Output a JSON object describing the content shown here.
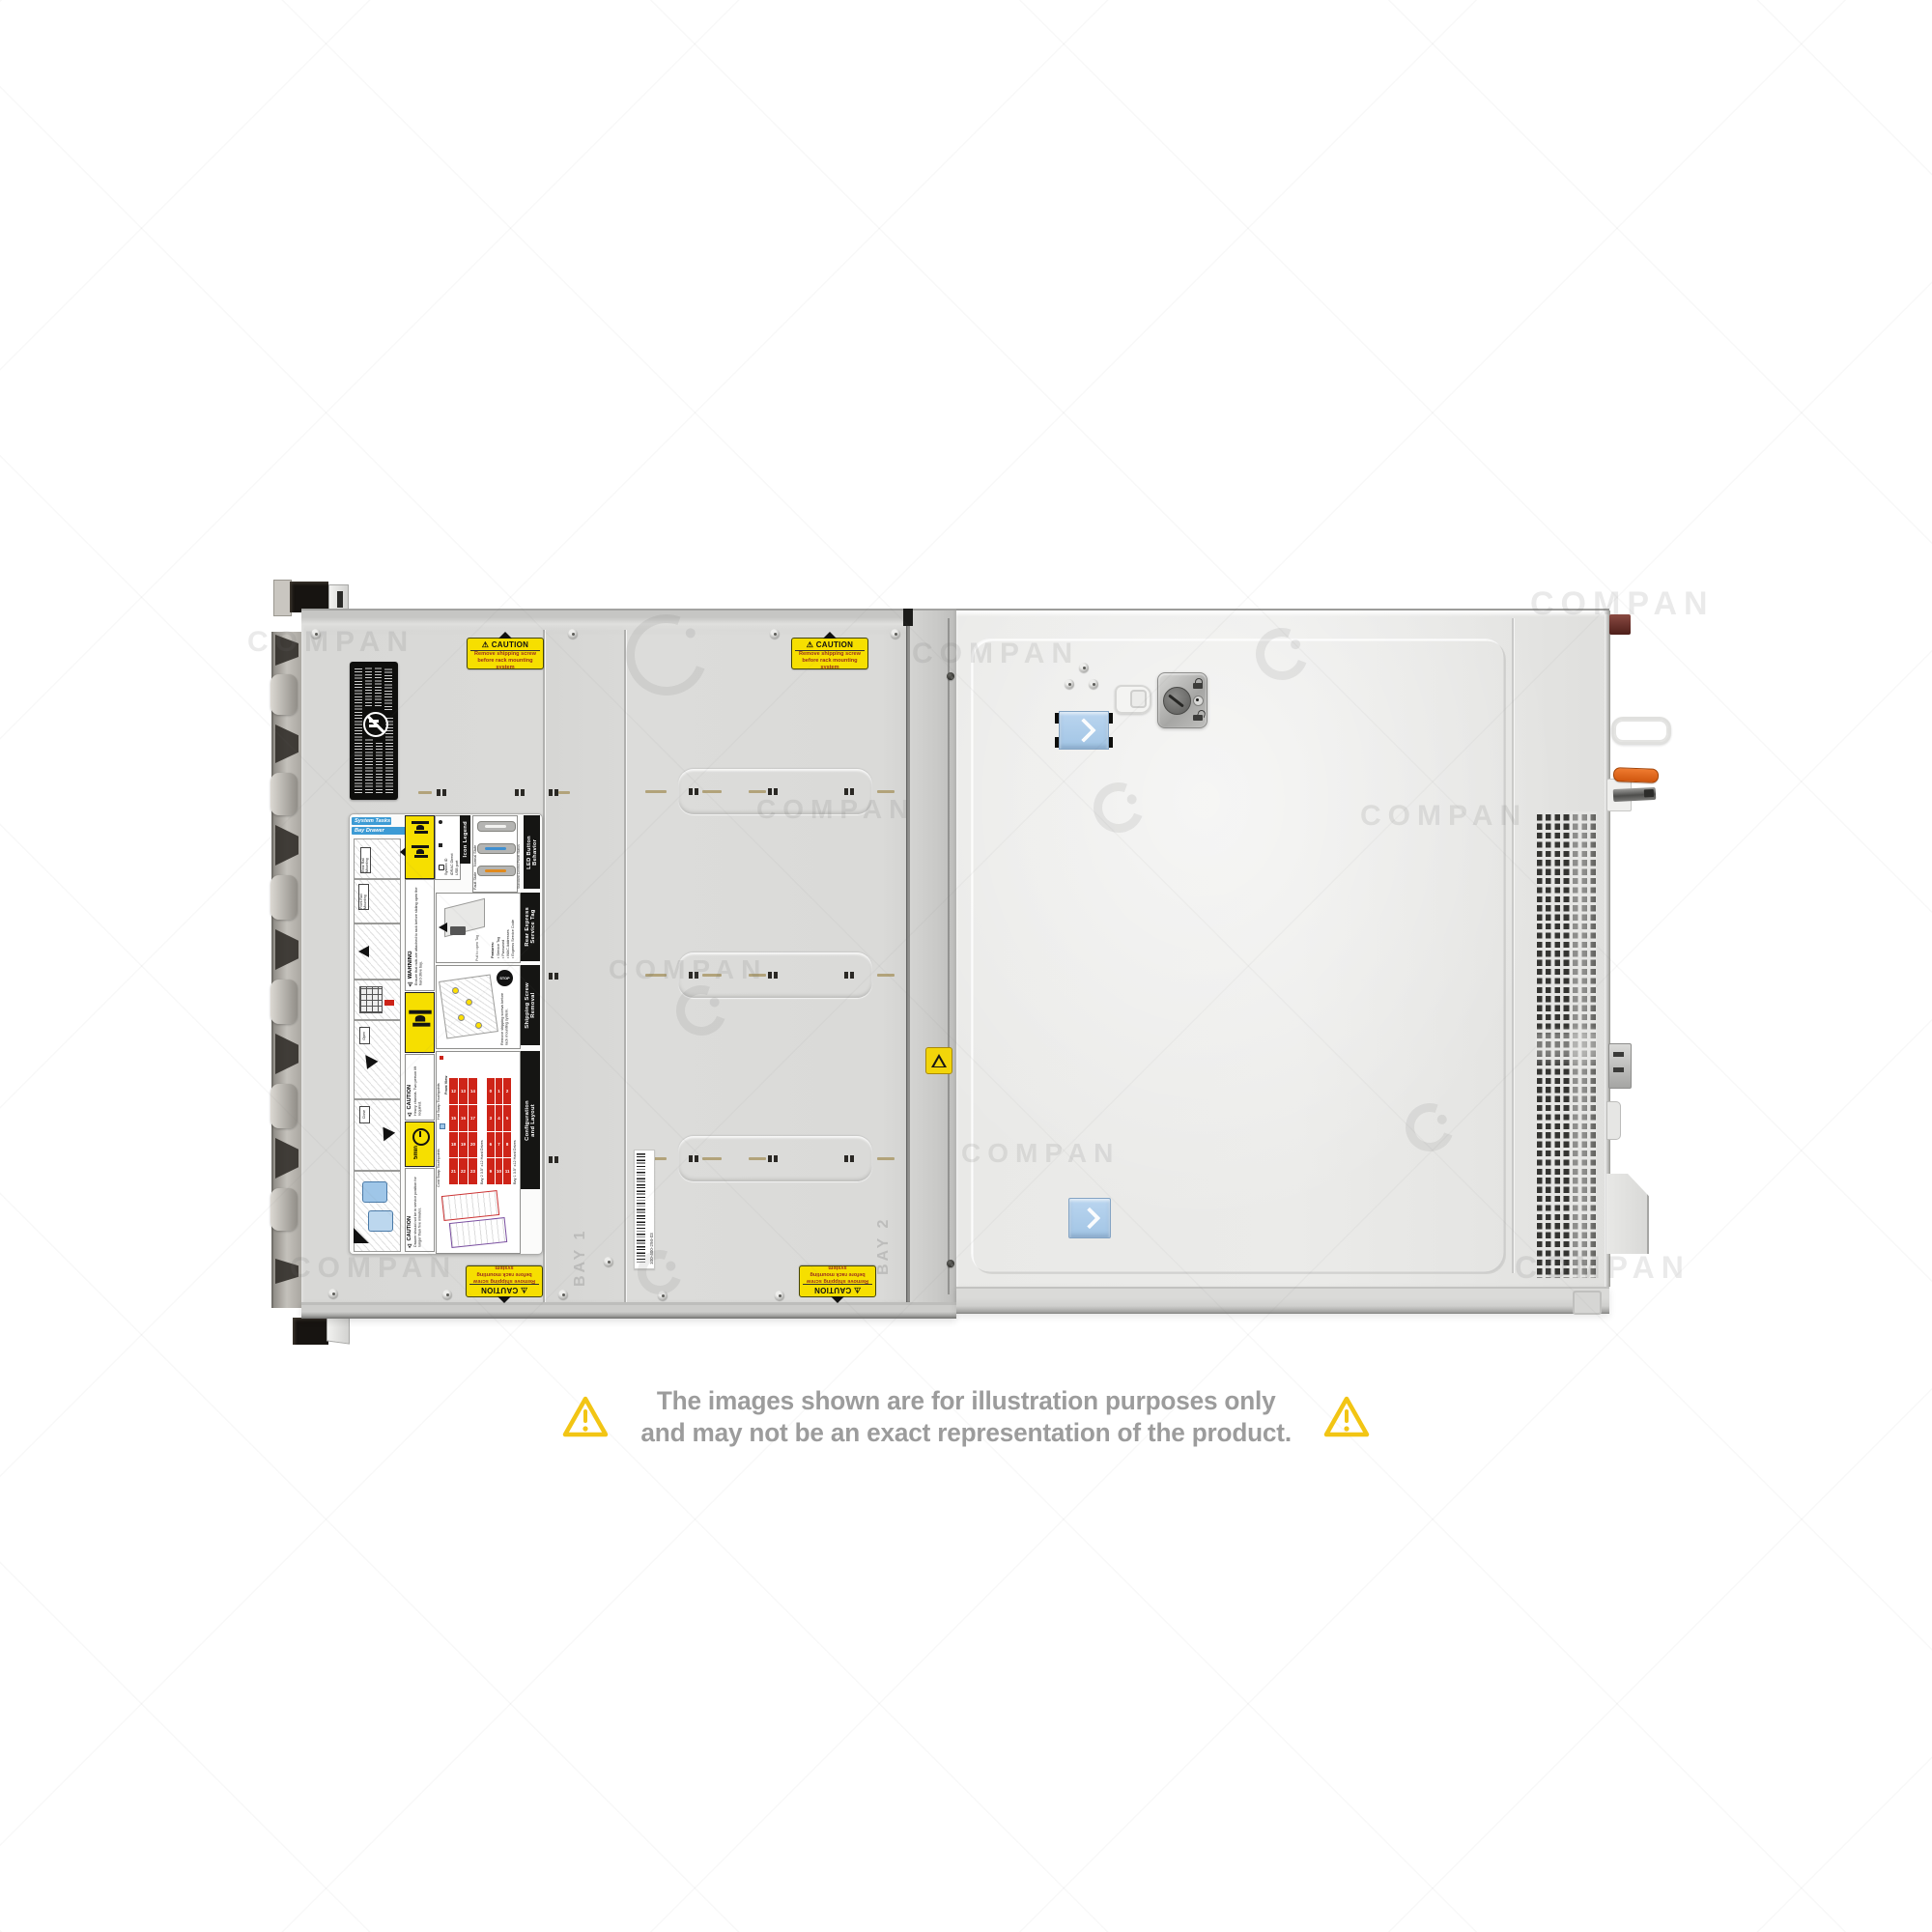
{
  "watermark": {
    "text": "COMPAN"
  },
  "disclaimer": {
    "line1": "The images shown are for illustration purposes only",
    "line2": "and may not be an exact representation of the product.",
    "warning_color": "#f2c514",
    "text_color": "#9c9c9c"
  },
  "caution_label": {
    "title": "⚠ CAUTION",
    "line1": "Remove shipping screw",
    "line2": "before rack mounting system"
  },
  "barcode_label": {
    "text": "100-400-294-03"
  },
  "panel_markings": {
    "bay1": "BAY 1",
    "bay2": "BAY 2"
  },
  "service_label": {
    "system_tasks": "System Tasks",
    "bay_drawer_operation": "Bay Drawer Operation",
    "rear_rail_mounting": "Rear Rail\nMounting",
    "front_rail_mounting": "Front Rail\nMounting",
    "open": "Open",
    "close": "Close",
    "warning_title": "⚠ WARNING",
    "warning_text": "Ensure that rails are attached to rack before sliding open the hard drive bay.",
    "caution_title": "⚠ CAUTION",
    "caution_heavy": "Heavy chassis. Two person lift required.",
    "caution_drawer": "Drawer should not be in service position for longer than five minutes.",
    "five_min": "5min",
    "icon_legend": {
      "title": "Icon Legend",
      "item1": "System ID",
      "item2": "iDRAC Direct",
      "item3": "USB port"
    },
    "led": {
      "title": "LED Button\nBehavior",
      "subtitle": "Standard Control Panel Status",
      "normal": "Normal State",
      "fault": "Fault State"
    },
    "rear_tag": {
      "title": "Rear Express\nService Tag",
      "features_title": "Features:",
      "f1": "• Service Tag",
      "f2": "• Password",
      "f3": "• MAC Addresses",
      "f4": "• Express Service Code",
      "pull": "Pull to open Tag"
    },
    "shipping": {
      "title": "Shipping Screw\nRemoval",
      "stop": "STOP",
      "text": "Remove shipping screws before rack mounting system."
    },
    "config": {
      "title": "Configuration\nand Layout",
      "front_view": "Front View",
      "hot": "Hot Swap Touchpoints",
      "cold": "Cold Swap Touchpoints",
      "bay2_caption": "Bay 2  3.5\" x12 Hard Drives",
      "bay1_caption": "Bay 1  3.5\" x12 Hard Drives",
      "table_left": [
        [
          "12",
          "13",
          "14"
        ],
        [
          "15",
          "16",
          "17"
        ],
        [
          "18",
          "19",
          "20"
        ],
        [
          "21",
          "22",
          "23"
        ]
      ],
      "table_right": [
        [
          "0",
          "1",
          "2"
        ],
        [
          "3",
          "4",
          "5"
        ],
        [
          "6",
          "7",
          "8"
        ],
        [
          "9",
          "10",
          "11"
        ]
      ]
    }
  }
}
